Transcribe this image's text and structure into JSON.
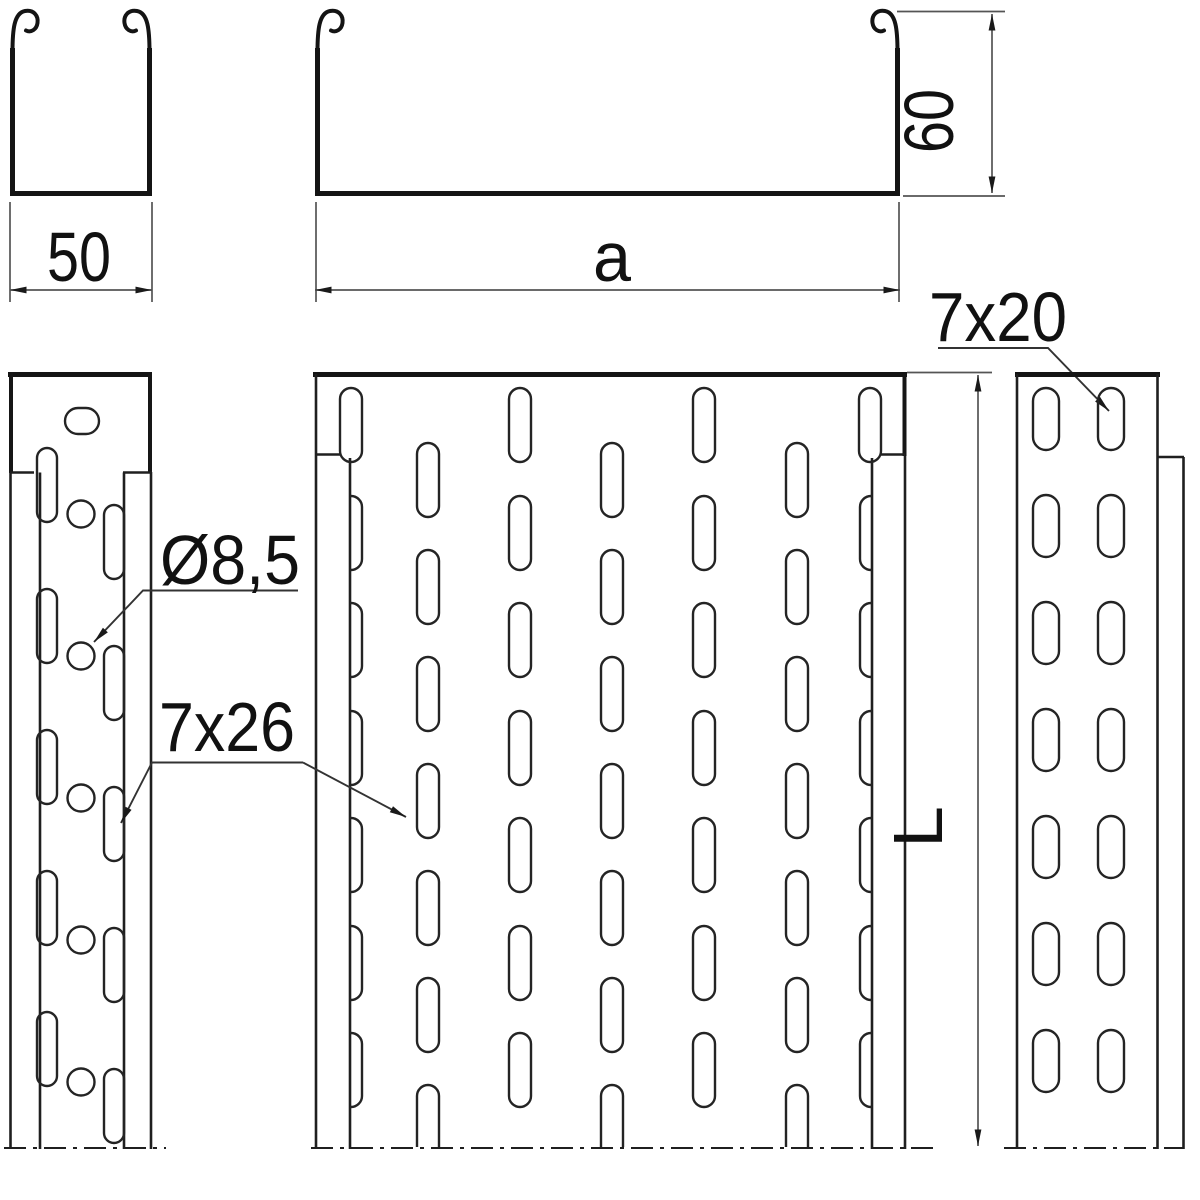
{
  "canvas": {
    "background": "#ffffff",
    "line_color": "#1a1a1a"
  },
  "dims": {
    "width_small": "50",
    "width_main": "a",
    "height_side": "60",
    "length": "L"
  },
  "labels": {
    "hole_diameter": "Ø8,5",
    "slot_side": "7x26",
    "slot_end": "7x20"
  }
}
